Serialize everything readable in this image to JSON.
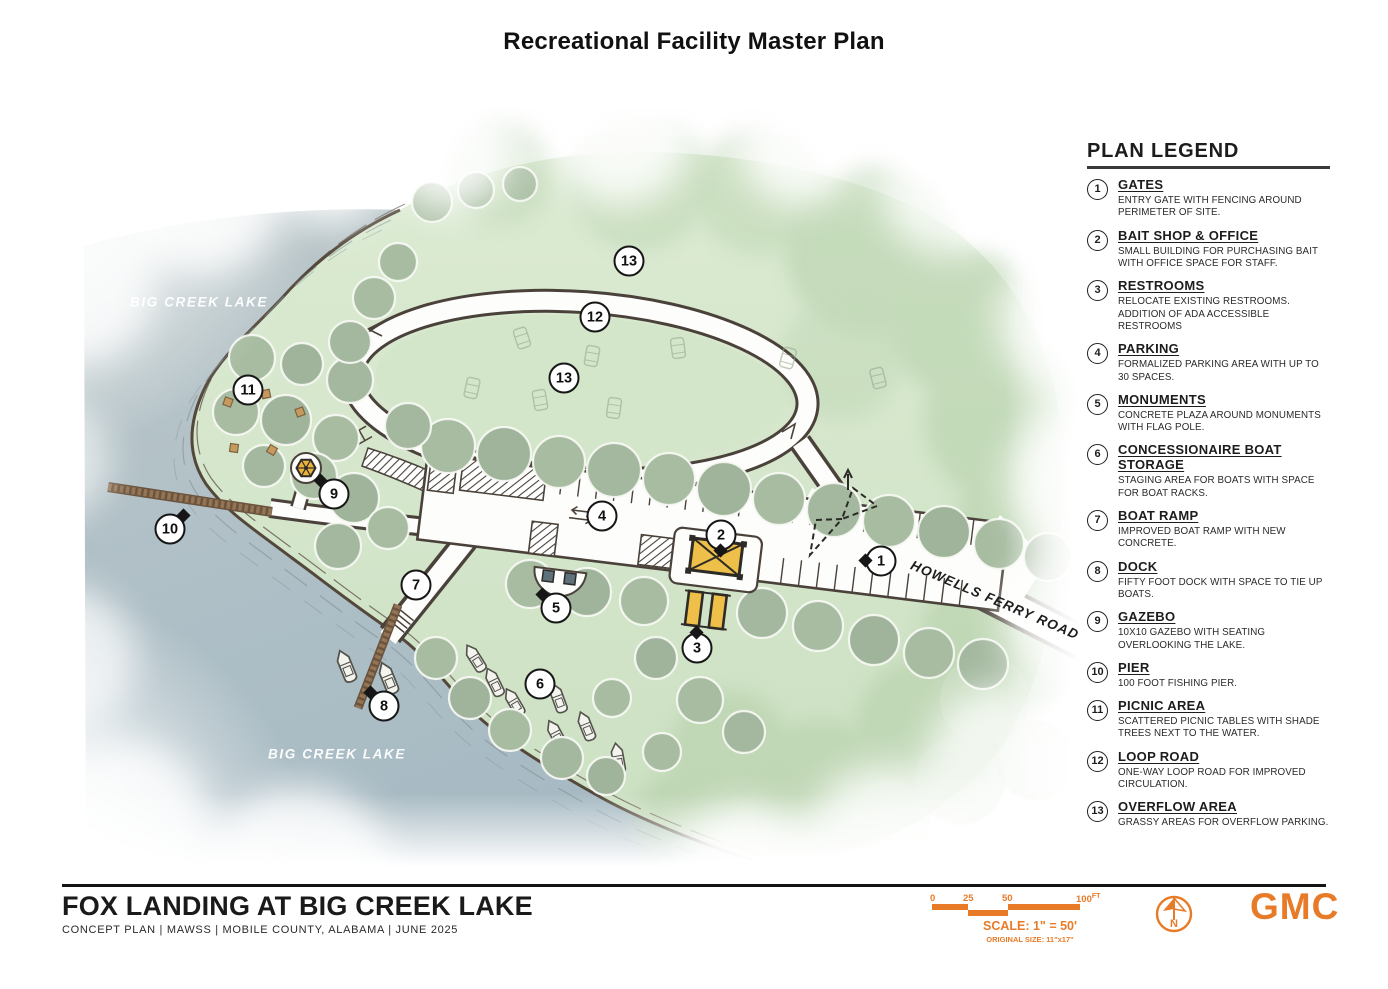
{
  "title": "Recreational Facility Master Plan",
  "legend": {
    "title": "PLAN LEGEND",
    "items": [
      {
        "num": "1",
        "title": "GATES",
        "desc": "ENTRY GATE WITH FENCING AROUND PERIMETER OF SITE."
      },
      {
        "num": "2",
        "title": "BAIT SHOP & OFFICE",
        "desc": "SMALL BUILDING FOR PURCHASING BAIT WITH OFFICE SPACE FOR STAFF."
      },
      {
        "num": "3",
        "title": "RESTROOMS",
        "desc": "RELOCATE EXISTING RESTROOMS. ADDITION OF ADA ACCESSIBLE RESTROOMS"
      },
      {
        "num": "4",
        "title": "PARKING",
        "desc": "FORMALIZED PARKING AREA WITH UP TO 30 SPACES."
      },
      {
        "num": "5",
        "title": "MONUMENTS",
        "desc": "CONCRETE PLAZA AROUND MONUMENTS WITH FLAG POLE."
      },
      {
        "num": "6",
        "title": "CONCESSIONAIRE BOAT STORAGE",
        "desc": "STAGING AREA FOR BOATS WITH SPACE FOR BOAT RACKS."
      },
      {
        "num": "7",
        "title": "BOAT RAMP",
        "desc": "IMPROVED BOAT RAMP WITH NEW CONCRETE."
      },
      {
        "num": "8",
        "title": "DOCK",
        "desc": "FIFTY FOOT DOCK WITH SPACE TO TIE UP BOATS."
      },
      {
        "num": "9",
        "title": "GAZEBO",
        "desc": "10X10 GAZEBO WITH SEATING OVERLOOKING THE LAKE."
      },
      {
        "num": "10",
        "title": "PIER",
        "desc": "100 FOOT FISHING PIER."
      },
      {
        "num": "11",
        "title": "PICNIC AREA",
        "desc": "SCATTERED PICNIC TABLES WITH SHADE TREES NEXT TO THE WATER."
      },
      {
        "num": "12",
        "title": "LOOP ROAD",
        "desc": "ONE-WAY LOOP ROAD FOR IMPROVED CIRCULATION."
      },
      {
        "num": "13",
        "title": "OVERFLOW AREA",
        "desc": "GRASSY AREAS FOR OVERFLOW PARKING."
      }
    ]
  },
  "plan": {
    "water_labels": [
      {
        "text": "BIG CREEK LAKE",
        "x": 199,
        "y": 242
      },
      {
        "text": "BIG CREEK LAKE",
        "x": 337,
        "y": 694
      }
    ],
    "road_label": {
      "text": "HOWELLS FERRY ROAD",
      "x": 995,
      "y": 540
    },
    "markers": [
      {
        "num": "1",
        "x": 881,
        "y": 501,
        "pointer": "left"
      },
      {
        "num": "2",
        "x": 721,
        "y": 475,
        "pointer": "down"
      },
      {
        "num": "3",
        "x": 697,
        "y": 588,
        "pointer": "up"
      },
      {
        "num": "4",
        "x": 602,
        "y": 456,
        "pointer": null
      },
      {
        "num": "5",
        "x": 556,
        "y": 548,
        "pointer": "up-left"
      },
      {
        "num": "6",
        "x": 540,
        "y": 624,
        "pointer": null
      },
      {
        "num": "7",
        "x": 416,
        "y": 525,
        "pointer": null
      },
      {
        "num": "8",
        "x": 384,
        "y": 646,
        "pointer": "up-left"
      },
      {
        "num": "9",
        "x": 334,
        "y": 434,
        "pointer": "up-left"
      },
      {
        "num": "10",
        "x": 170,
        "y": 469,
        "pointer": "up-right"
      },
      {
        "num": "11",
        "x": 248,
        "y": 330,
        "pointer": null
      },
      {
        "num": "12",
        "x": 595,
        "y": 257,
        "pointer": null
      },
      {
        "num": "13",
        "x": 629,
        "y": 201,
        "pointer": null
      },
      {
        "num": "13",
        "x": 564,
        "y": 318,
        "pointer": null
      }
    ]
  },
  "footer": {
    "project_title": "FOX LANDING AT BIG CREEK LAKE",
    "project_meta": "CONCEPT PLAN  |  MAWSS  |  MOBILE COUNTY, ALABAMA  |  JUNE 2025",
    "scale": {
      "ticks": [
        "0",
        "25",
        "50",
        "100"
      ],
      "unit": "FT",
      "label": "SCALE: 1\" = 50'",
      "original": "ORIGINAL SIZE: 11\"x17\""
    },
    "north_letter": "N",
    "logo_text": "GMC"
  },
  "colors": {
    "accent_orange": "#e87b28",
    "water": "#aebfc6",
    "grass": "#d3e3c9",
    "road_outline": "#4a423a",
    "building_yellow": "#eec04a"
  }
}
